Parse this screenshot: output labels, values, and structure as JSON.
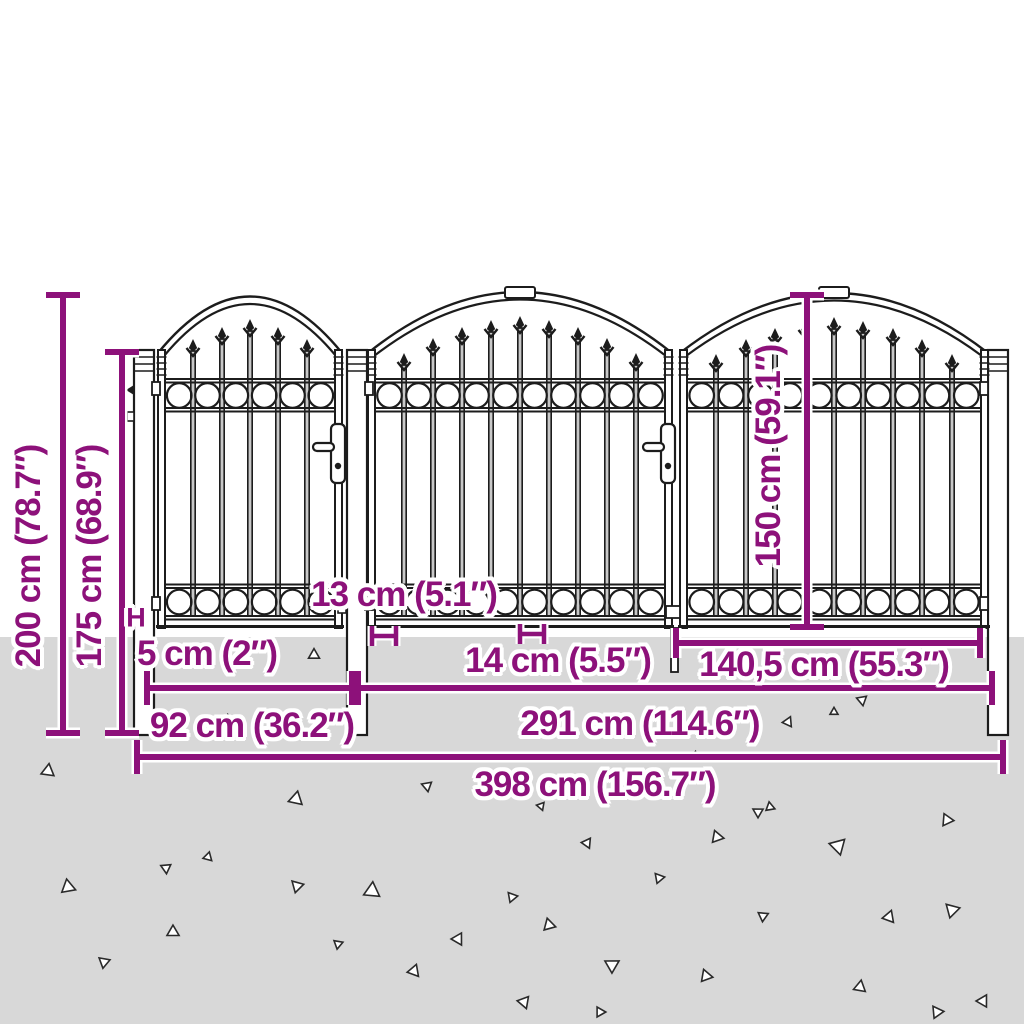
{
  "diagram": {
    "kind": "product dimension diagram",
    "subject": "garden gate set with arched top, spear finials and ring ornament bands",
    "accent_color": "#8D117A",
    "ground_color": "#D8D8D8",
    "labels": {
      "total_height": "200 cm (78.7″)",
      "structure_height": "175 cm (68.9″)",
      "leaf_height": "150 cm (59.1″)",
      "ground_clearance": "5 cm (2″)",
      "marker_h": "H",
      "bar_gap_small": "13 cm (5.1″)",
      "bar_gap_large": "14 cm (5.5″)",
      "leaf_width": "140,5 cm (55.3″)",
      "single_gate_width": "92 cm (36.2″)",
      "double_gate_width": "291 cm (114.6″)",
      "total_width": "398 cm (156.7″)"
    }
  }
}
